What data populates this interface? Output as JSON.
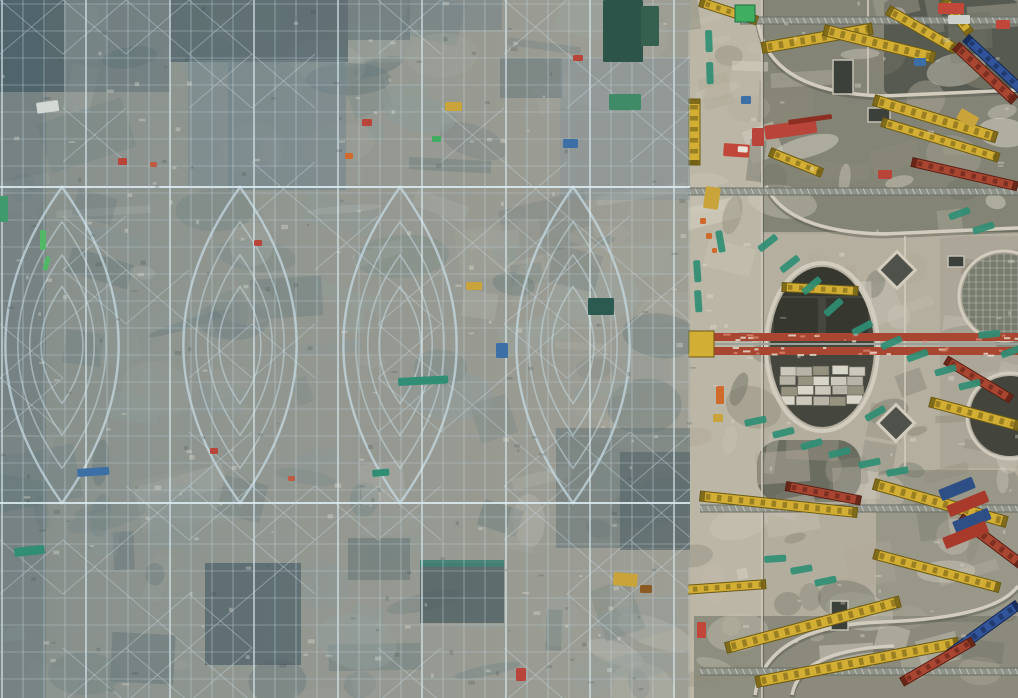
{
  "meta": {
    "type": "aerial-photograph",
    "subject": "Top-down drone view of a large construction site",
    "left_area": "Dense blue-grey steel scaffolding with curved lattice roof arches (pointed-oval diagrid shells) under construction over mottled concrete",
    "right_area": "Concrete deck with circular and diamond openings, yellow/red/blue lattice truss crane booms, green safety walkway mats and material stacks",
    "divider": "Light concrete service corridor running vertically between scaffold zone and deck zone"
  },
  "canvas": {
    "width": 1018,
    "height": 698,
    "seed": 11
  },
  "palette": {
    "base": "#a7a193",
    "deck_base": "#b3ad9e",
    "road": "#bcb6a6",
    "steel_line": "rgba(198,216,224,0.5)",
    "steel_line_h": "rgba(188,206,214,0.40)",
    "steel_major": "rgba(220,236,242,0.85)",
    "brace": "rgba(200,218,226,0.42)",
    "arch": "rgba(200,220,228,0.8)",
    "spring_line": "rgba(218,234,240,0.9)",
    "rim_light": "#d2ccbe",
    "rim_dark": "#55594e",
    "crane_yellow": "#d3ae34",
    "crane_yellow_dark": "#6b5a14",
    "truss_red": "#a84632",
    "truss_red_dark": "#591f14",
    "truss_blue": "#31549a",
    "truss_blue_dark": "#14274f",
    "safety_teal": "#2f8e74",
    "gray_truss": "#8f948c",
    "gray_truss_tick": "#c9cec4",
    "speckle_light": "#e6e2d6",
    "speckle_dark": "#3c4848",
    "tint_start": "rgba(86,116,128,0.40)",
    "tint_end": "rgba(120,144,152,0.20)",
    "tint_left_edge": "rgba(60,88,100,0.22)"
  },
  "zones": {
    "scaffold": {
      "x": 0,
      "y": 0,
      "w": 690,
      "h": 698
    },
    "corridor": {
      "x": 687,
      "y": 0,
      "w": 76,
      "h": 698
    },
    "deck": {
      "x": 688,
      "y": 0,
      "w": 330,
      "h": 698
    }
  },
  "scaffold": {
    "grid": {
      "vs": 21,
      "hs": 27,
      "major_every": 4,
      "brace_w": 63,
      "brace_h": 54,
      "brace_p": 0.38
    },
    "spring_lines_y": [
      187,
      503
    ],
    "eyes": {
      "cy": 345,
      "cx": [
        62,
        240,
        400,
        573
      ],
      "rx": 96,
      "ry": 158,
      "rings": [
        1,
        0.78,
        0.57,
        0.37
      ],
      "bulge": 1.18
    },
    "panels": [
      [
        0,
        0,
        64,
        92,
        "#465457",
        0.85
      ],
      [
        64,
        0,
        106,
        92,
        "#5c6a6e",
        0.5
      ],
      [
        170,
        0,
        178,
        62,
        "#4d5b5f",
        0.8
      ],
      [
        348,
        0,
        62,
        40,
        "#5a686c",
        0.55
      ],
      [
        410,
        0,
        92,
        30,
        "#6d7a7e",
        0.45
      ],
      [
        188,
        60,
        44,
        128,
        "#828f93",
        0.55
      ],
      [
        228,
        60,
        118,
        130,
        "#78878c",
        0.6
      ],
      [
        500,
        58,
        62,
        40,
        "#5f6d70",
        0.5
      ],
      [
        560,
        58,
        130,
        142,
        "#87949a",
        0.4
      ],
      [
        205,
        563,
        96,
        102,
        "#47555a",
        0.75
      ],
      [
        420,
        563,
        84,
        60,
        "#3f4e4e",
        0.75
      ],
      [
        420,
        560,
        84,
        7,
        "#2f7e6a",
        0.9
      ],
      [
        556,
        428,
        136,
        120,
        "#5b6a6a",
        0.5
      ],
      [
        620,
        452,
        70,
        98,
        "#4c5a5c",
        0.6
      ],
      [
        348,
        538,
        62,
        42,
        "#54625f",
        0.45
      ]
    ],
    "patches": {
      "n": 160,
      "x": 0,
      "y": 0,
      "w": 690,
      "h": 698,
      "colors": [
        "#b7b0a1",
        "#cdc7b8",
        "#9aa49e",
        "#75837f",
        "#a8b0a4",
        "#5f6e6e"
      ],
      "omin": 0.2,
      "omax": 0.45,
      "smin": 12,
      "smax": 95
    },
    "accents": [
      [
        36,
        103,
        22,
        11,
        "#d4d8d4",
        -8
      ],
      [
        0,
        196,
        8,
        26,
        "#3f9a6c",
        0
      ],
      [
        40,
        230,
        6,
        20,
        "#52b868",
        0
      ],
      [
        46,
        256,
        5,
        14,
        "#52b868",
        15
      ],
      [
        118,
        158,
        9,
        7,
        "#b8443a",
        0
      ],
      [
        150,
        162,
        7,
        5,
        "#c05a40",
        0
      ],
      [
        362,
        119,
        10,
        7,
        "#b8443a",
        0
      ],
      [
        345,
        153,
        8,
        6,
        "#d06a2c",
        0
      ],
      [
        573,
        55,
        10,
        6,
        "#b8443a",
        0
      ],
      [
        603,
        0,
        40,
        62,
        "#2d5448",
        0
      ],
      [
        641,
        6,
        18,
        40,
        "#35604f",
        0
      ],
      [
        609,
        94,
        32,
        16,
        "#3f8a67",
        0
      ],
      [
        563,
        139,
        15,
        9,
        "#3b6fa6",
        0
      ],
      [
        588,
        298,
        26,
        17,
        "#2b5a50",
        0
      ],
      [
        496,
        343,
        12,
        15,
        "#3b6fa6",
        0
      ],
      [
        445,
        102,
        17,
        9,
        "#c9a43a",
        0
      ],
      [
        398,
        378,
        50,
        8,
        "#2f8e74",
        -3
      ],
      [
        372,
        470,
        17,
        7,
        "#2f8e74",
        -5
      ],
      [
        14,
        548,
        30,
        9,
        "#2f8e74",
        -6
      ],
      [
        77,
        469,
        32,
        8,
        "#3b6fa6",
        -4
      ],
      [
        614,
        572,
        24,
        13,
        "#c9a43a",
        5
      ],
      [
        640,
        585,
        12,
        8,
        "#8a5a20",
        0
      ],
      [
        516,
        668,
        10,
        13,
        "#b8443a",
        0
      ],
      [
        254,
        240,
        8,
        6,
        "#b8443a",
        0
      ],
      [
        432,
        136,
        9,
        6,
        "#3fae60",
        0
      ],
      [
        466,
        282,
        16,
        8,
        "#c9a43a",
        0
      ],
      [
        210,
        448,
        8,
        6,
        "#b8443a",
        0
      ],
      [
        288,
        476,
        7,
        5,
        "#c05a40",
        0
      ]
    ]
  },
  "deck": {
    "islands": [
      [
        762,
        0,
        256,
        96,
        "#62675b",
        0.6,
        0
      ],
      [
        884,
        0,
        134,
        94,
        "#4f544a",
        0.85,
        6
      ],
      [
        762,
        96,
        256,
        138,
        "#6a6e60",
        0.65,
        0
      ],
      [
        762,
        232,
        256,
        240,
        "#b5afa0",
        0.85,
        0
      ],
      [
        876,
        470,
        142,
        152,
        "#7d8171",
        0.5,
        10
      ],
      [
        694,
        616,
        324,
        82,
        "#6f7366",
        0.6,
        0
      ],
      [
        757,
        440,
        104,
        62,
        "#585c50",
        0.8,
        24
      ],
      [
        940,
        236,
        78,
        232,
        "#a39d8f",
        0.5,
        0
      ]
    ],
    "patches": {
      "n": 130,
      "x": 688,
      "y": 0,
      "w": 330,
      "h": 698,
      "colors": [
        "#d6d1c3",
        "#c6c0b1",
        "#b0a999",
        "#8f8a7b",
        "#6f7366"
      ],
      "omin": 0.25,
      "omax": 0.55,
      "smin": 10,
      "smax": 70
    },
    "curves": [
      "M 758,22 Q 768,92 882,96",
      "M 882,96 L 1018,90",
      "M 766,186 Q 788,232 884,234",
      "M 884,234 L 1018,228",
      "M 755,695 Q 766,626 882,622 Q 995,618 1018,586",
      "M 792,695 Q 800,650 894,646"
    ],
    "joints": [
      [
        762,
        0,
        762,
        698
      ],
      [
        868,
        0,
        868,
        96
      ],
      [
        905,
        236,
        905,
        470
      ]
    ],
    "circle_main": {
      "cx": 822,
      "cy": 347,
      "rx": 52,
      "ry": 80,
      "fill": "#45473f",
      "inner_darks": [
        [
          774,
          298,
          44,
          38
        ],
        [
          826,
          298,
          42,
          38
        ],
        [
          778,
          260,
          88,
          36
        ]
      ],
      "pallets": {
        "x0": 780,
        "y0": 366,
        "cols": 5,
        "rows": 4,
        "cw": 16,
        "ch": 9,
        "gx": 1,
        "gy": 1,
        "colors": [
          "#ccc8bc",
          "#b7b3a7",
          "#95927f",
          "#d8d5c9"
        ]
      }
    },
    "circle_covered": {
      "cx": 1004,
      "cy": 296,
      "r": 42,
      "fill": "#777c6e"
    },
    "circle_dark": {
      "cx": 1010,
      "cy": 416,
      "r": 40,
      "fill": "#43453d"
    },
    "diamonds": [
      [
        897,
        270,
        26
      ],
      [
        896,
        423,
        26
      ]
    ],
    "pits": [
      [
        833,
        60,
        20,
        34
      ],
      [
        868,
        108,
        22,
        14
      ],
      [
        948,
        256,
        16,
        11
      ],
      [
        831,
        601,
        17,
        29
      ],
      [
        737,
        332,
        16,
        10
      ]
    ],
    "red_truss": {
      "x": 688,
      "y": 333,
      "len": 330,
      "band": 8,
      "gap": 6
    },
    "gray_trusses": [
      [
        740,
        17,
        278
      ],
      [
        688,
        188,
        330
      ],
      [
        700,
        505,
        318
      ],
      [
        700,
        668,
        318
      ]
    ],
    "booms": [
      {
        "x": 762,
        "y": 48,
        "len": 112,
        "ang": -10,
        "w": 11,
        "c": "yellow"
      },
      {
        "x": 824,
        "y": 30,
        "len": 114,
        "ang": 14,
        "w": 11,
        "c": "yellow"
      },
      {
        "x": 888,
        "y": 10,
        "len": 78,
        "ang": 30,
        "w": 10,
        "c": "yellow"
      },
      {
        "x": 700,
        "y": 2,
        "len": 60,
        "ang": 18,
        "w": 9,
        "c": "yellow"
      },
      {
        "x": 944,
        "y": 0,
        "len": 42,
        "ang": 52,
        "w": 9,
        "c": "yellow"
      },
      {
        "x": 956,
        "y": 46,
        "len": 80,
        "ang": 43,
        "w": 10,
        "c": "red"
      },
      {
        "x": 966,
        "y": 38,
        "len": 96,
        "ang": 43,
        "w": 9,
        "c": "blue"
      },
      {
        "x": 874,
        "y": 100,
        "len": 128,
        "ang": 17,
        "w": 11,
        "c": "yellow"
      },
      {
        "x": 882,
        "y": 122,
        "len": 122,
        "ang": 17,
        "w": 9,
        "c": "yellow"
      },
      {
        "x": 912,
        "y": 162,
        "len": 108,
        "ang": 13,
        "w": 9,
        "c": "red"
      },
      {
        "x": 770,
        "y": 152,
        "len": 56,
        "ang": 22,
        "w": 9,
        "c": "yellow"
      },
      {
        "x": 694,
        "y": 99,
        "len": 66,
        "ang": 90,
        "w": 12,
        "c": "yellow"
      },
      {
        "x": 782,
        "y": 287,
        "len": 76,
        "ang": 3,
        "w": 9,
        "c": "yellow"
      },
      {
        "x": 930,
        "y": 402,
        "len": 92,
        "ang": 15,
        "w": 10,
        "c": "yellow"
      },
      {
        "x": 946,
        "y": 360,
        "len": 76,
        "ang": 31,
        "w": 9,
        "c": "red"
      },
      {
        "x": 700,
        "y": 496,
        "len": 158,
        "ang": 6,
        "w": 10,
        "c": "yellow"
      },
      {
        "x": 786,
        "y": 486,
        "len": 76,
        "ang": 11,
        "w": 9,
        "c": "red"
      },
      {
        "x": 874,
        "y": 484,
        "len": 138,
        "ang": 16,
        "w": 11,
        "c": "yellow"
      },
      {
        "x": 960,
        "y": 518,
        "len": 76,
        "ang": 37,
        "w": 10,
        "c": "red"
      },
      {
        "x": 874,
        "y": 554,
        "len": 130,
        "ang": 15,
        "w": 10,
        "c": "yellow"
      },
      {
        "x": 726,
        "y": 648,
        "len": 180,
        "ang": -15,
        "w": 11,
        "c": "yellow"
      },
      {
        "x": 756,
        "y": 682,
        "len": 206,
        "ang": -11,
        "w": 11,
        "c": "yellow"
      },
      {
        "x": 950,
        "y": 654,
        "len": 84,
        "ang": -36,
        "w": 10,
        "c": "blue"
      },
      {
        "x": 902,
        "y": 682,
        "len": 82,
        "ang": -30,
        "w": 9,
        "c": "red"
      },
      {
        "x": 654,
        "y": 592,
        "len": 112,
        "ang": -4,
        "w": 9,
        "c": "yellow"
      }
    ],
    "green_square": [
      735,
      5,
      20,
      17,
      "#3fae60"
    ],
    "strips": [
      [
        757,
        247,
        -38
      ],
      [
        779,
        268,
        -38
      ],
      [
        801,
        290,
        -40
      ],
      [
        823,
        312,
        -42
      ],
      [
        851,
        330,
        -28
      ],
      [
        880,
        344,
        -24
      ],
      [
        906,
        356,
        -20
      ],
      [
        934,
        370,
        -16
      ],
      [
        958,
        384,
        -14
      ],
      [
        744,
        420,
        -12
      ],
      [
        772,
        432,
        -14
      ],
      [
        800,
        444,
        -16
      ],
      [
        828,
        452,
        -14
      ],
      [
        858,
        462,
        -12
      ],
      [
        886,
        470,
        -10
      ],
      [
        700,
        260,
        86
      ],
      [
        701,
        290,
        86
      ],
      [
        722,
        230,
        80
      ],
      [
        712,
        30,
        88
      ],
      [
        713,
        62,
        88
      ],
      [
        764,
        556,
        -4
      ],
      [
        790,
        568,
        -10
      ],
      [
        814,
        580,
        -12
      ],
      [
        948,
        214,
        -20
      ],
      [
        972,
        228,
        -18
      ],
      [
        864,
        416,
        -30
      ],
      [
        978,
        332,
        -6
      ],
      [
        1000,
        352,
        -20
      ]
    ],
    "accents": [
      [
        938,
        3,
        26,
        11,
        "#c0473a",
        0
      ],
      [
        948,
        15,
        22,
        9,
        "#cdd1cd",
        0
      ],
      [
        764,
        126,
        52,
        14,
        "#b8443a",
        -8
      ],
      [
        788,
        120,
        44,
        5,
        "#8c2f22",
        -8
      ],
      [
        724,
        143,
        26,
        13,
        "#c0473a",
        4
      ],
      [
        738,
        146,
        10,
        6,
        "#e8e4da",
        4
      ],
      [
        706,
        186,
        15,
        22,
        "#c9a43a",
        8
      ],
      [
        752,
        128,
        12,
        18,
        "#b8443a",
        0
      ],
      [
        741,
        96,
        10,
        8,
        "#3b6fa6",
        0
      ],
      [
        700,
        218,
        6,
        6,
        "#d06a2c",
        0
      ],
      [
        706,
        233,
        6,
        6,
        "#d06a2c",
        0
      ],
      [
        712,
        248,
        5,
        5,
        "#d06a2c",
        0
      ],
      [
        697,
        622,
        9,
        16,
        "#c0473a",
        0
      ],
      [
        938,
        490,
        36,
        12,
        "#2e4f86",
        -22
      ],
      [
        946,
        506,
        42,
        12,
        "#a83a2c",
        -22
      ],
      [
        952,
        522,
        38,
        12,
        "#2e4f86",
        -22
      ],
      [
        942,
        538,
        46,
        12,
        "#a83a2c",
        -22
      ],
      [
        878,
        170,
        14,
        9,
        "#b8443a",
        0
      ],
      [
        914,
        58,
        12,
        8,
        "#3b6fa6",
        0
      ],
      [
        962,
        108,
        20,
        12,
        "#c9a43a",
        30
      ],
      [
        996,
        20,
        14,
        9,
        "#c0473a",
        0
      ],
      [
        716,
        386,
        8,
        18,
        "#d06a2c",
        0
      ],
      [
        713,
        414,
        10,
        8,
        "#c9a43a",
        0
      ]
    ]
  },
  "speckles": {
    "light_n": 170,
    "dark_n": 110
  }
}
